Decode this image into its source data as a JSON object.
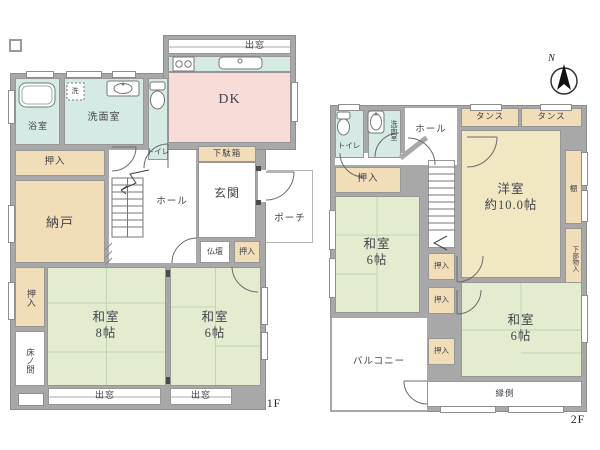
{
  "title": "間取り図",
  "colors": {
    "wall": "#a8a8a8",
    "water_rooms": "#d6eae5",
    "dk": "#f8dcd7",
    "storage": "#f2ddb9",
    "tatami": "#e3eccf",
    "western_room": "#f2e7c3",
    "background": "#ffffff"
  },
  "floor1": {
    "label": "1F",
    "rooms": {
      "demado_top": "出窓",
      "dk": "DK",
      "bath": "浴室",
      "washroom": "洗面室",
      "washer": "洗",
      "toilet": "トイレ",
      "oshiire_top": "押入",
      "nando": "納戸",
      "hall": "ホール",
      "getabako": "下駄箱",
      "genkan": "玄関",
      "porch": "ポーチ",
      "butsudan": "仏壇",
      "oshiire_mini": "押入",
      "oshiire_left": "押入",
      "tokonoma": "床ノ間",
      "washitsu8": "和室\n8帖",
      "washitsu6": "和室\n6帖",
      "demado_left": "出窓",
      "demado_right": "出窓"
    }
  },
  "floor2": {
    "label": "2F",
    "compass_n": "N",
    "rooms": {
      "toilet": "トイレ",
      "washroom": "洗面室",
      "hall": "ホール",
      "tansu_left": "タンス",
      "tansu_right": "タンス",
      "oshiire_top": "押入",
      "yoshitsu": "洋室\n約10.0帖",
      "tana": "棚",
      "shita_mono": "下部物入",
      "washitsu_a": "和室\n6帖",
      "oshiire_1": "押入",
      "oshiire_2": "押入",
      "oshiire_3": "押入",
      "washitsu_b": "和室\n6帖",
      "balcony": "バルコニー",
      "engawa": "縁側"
    }
  }
}
